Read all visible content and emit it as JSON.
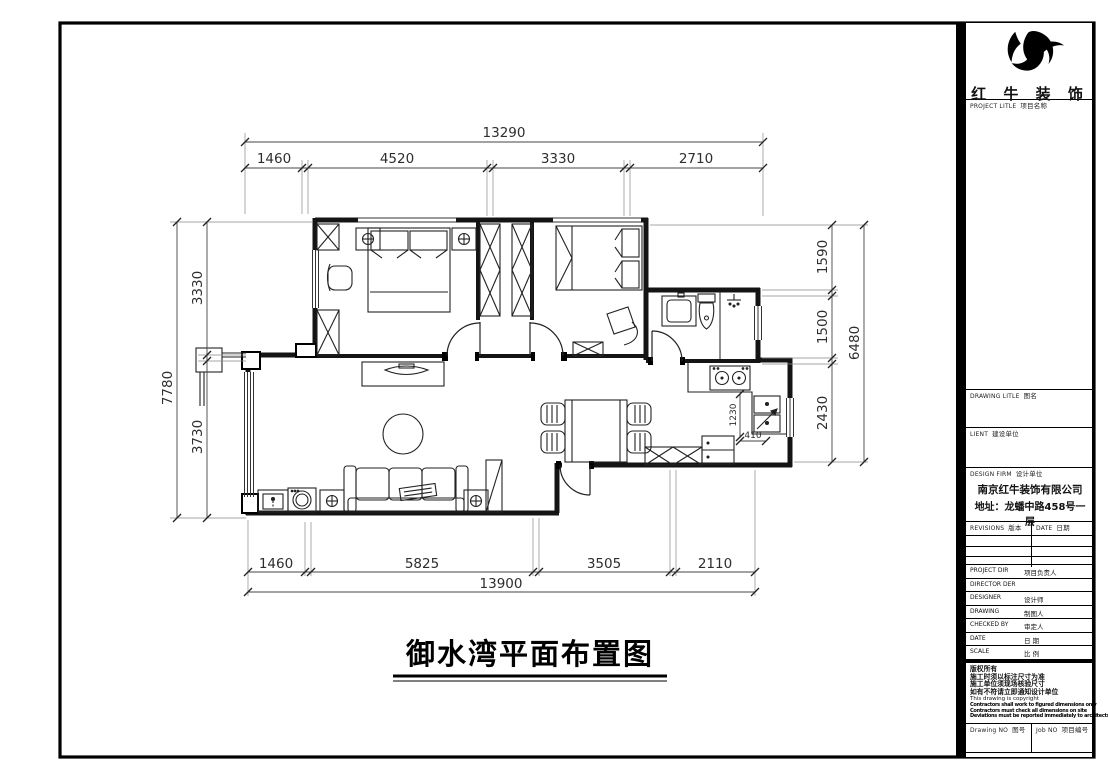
{
  "brand": {
    "name": "红 牛 装 饰"
  },
  "title_block": {
    "project_label": "PROJECT LITLE",
    "project_label_cn": "项目名称",
    "drawing_label": "DRAWING LITLE",
    "drawing_label_cn": "图名",
    "client_label": "LIENT",
    "client_label_cn": "建设单位",
    "design_firm_label": "DESIGN FIRM",
    "design_firm_label_cn": "设计单位",
    "firm_name": "南京红牛装饰有限公司",
    "firm_address_line1": "地址：龙蟠中路458号一",
    "firm_address_line2": "层",
    "revisions_label": "REVISIONS",
    "revisions_label_cn": "版本",
    "revisions_date_label": "DATE",
    "revisions_date_label_cn": "日期",
    "rows": [
      {
        "en": "PROJECT DIR",
        "cn": "项目负责人"
      },
      {
        "en": "DIRECTOR DER",
        "cn": ""
      },
      {
        "en": "DESIGNER",
        "cn": "设计师"
      },
      {
        "en": "DRAWING",
        "cn": "制图人"
      },
      {
        "en": "CHECKED BY",
        "cn": "审定人"
      },
      {
        "en": "DATE",
        "cn": "日 期"
      },
      {
        "en": "SCALE",
        "cn": "比 例"
      }
    ],
    "copyright": [
      "版权所有",
      "施工时须以标注尺寸为准",
      "施工单位须现场核验尺寸",
      "如有不符请立即通知设计单位",
      "This drawing is copyright",
      "Contractors shall work to figured dimensions only",
      "Contractors must check all dimensions on site",
      "Deviations must be reported immediately to architects"
    ],
    "drawing_no_label": "Drawing NO",
    "drawing_no_label_cn": "图号",
    "job_no_label": "Job NO",
    "job_no_label_cn": "项目编号"
  },
  "plan": {
    "title": "御水湾平面布置图",
    "dims": {
      "top": {
        "total": "13290",
        "segments": [
          "1460",
          "4520",
          "3330",
          "2710"
        ]
      },
      "bottom": {
        "total": "13900",
        "segments": [
          "1460",
          "5825",
          "3505",
          "2110"
        ]
      },
      "left": {
        "total": "7780",
        "segments": [
          "3330",
          "3730"
        ]
      },
      "right": {
        "total": "6480",
        "segments": [
          "1590",
          "1500",
          "2430"
        ]
      },
      "kitchen": {
        "depth": "1230",
        "offset": "410"
      }
    }
  }
}
